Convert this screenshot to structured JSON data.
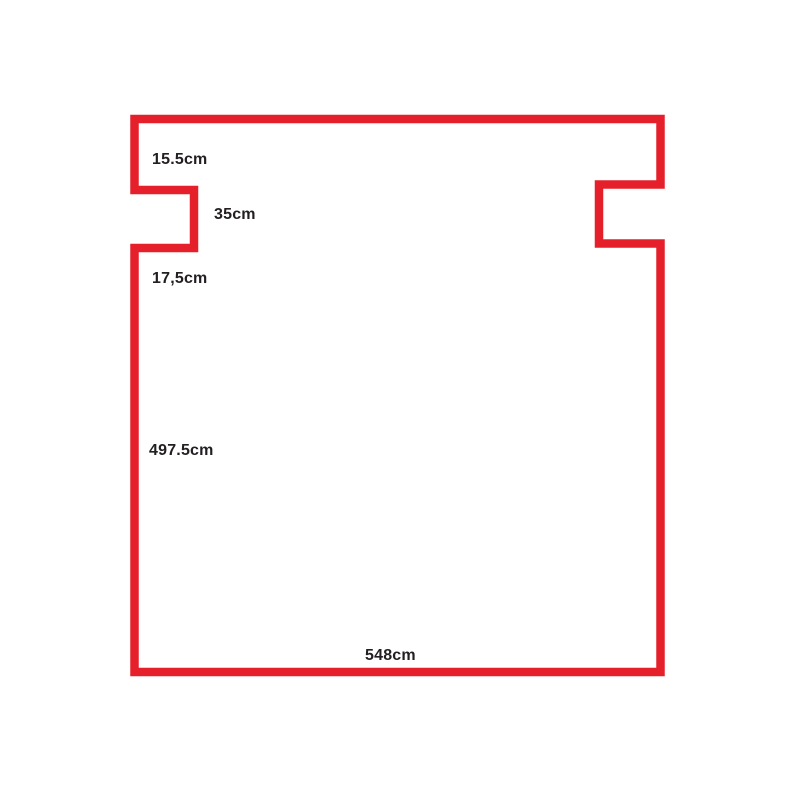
{
  "canvas": {
    "width": 800,
    "height": 800,
    "background_color": "#ffffff"
  },
  "diagram": {
    "kind": "room-outline-floor-plan-sketch",
    "unit": "cm",
    "outline_color": "#e6202b",
    "label_color": "#221e21",
    "labels": [
      {
        "name": "upper-left-wall-segment-height",
        "text": "15.5cm"
      },
      {
        "name": "left-notch-height",
        "text": "35cm"
      },
      {
        "name": "below-left-notch-segment-height",
        "text": "17,5cm"
      },
      {
        "name": "left-wall-main-height",
        "text": "497.5cm"
      },
      {
        "name": "bottom-wall-width",
        "text": "548cm"
      }
    ]
  }
}
